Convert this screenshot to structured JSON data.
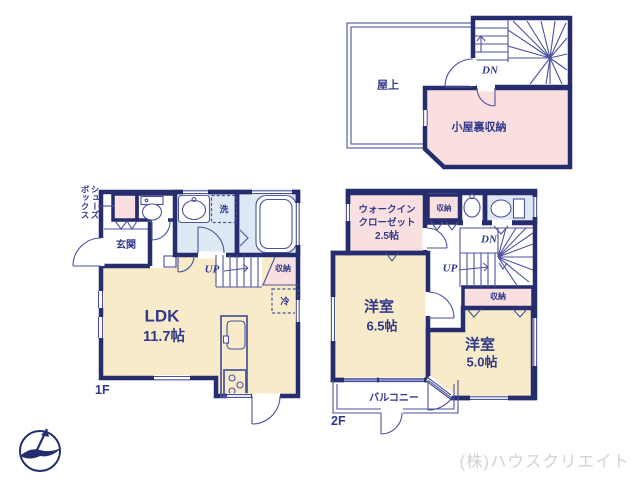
{
  "colors": {
    "wall": "#262d6e",
    "line": "#4b529c",
    "label": "#32398a",
    "cream": "#f7ebc9",
    "pink": "#f9dfdf",
    "blue": "#dfe9f5",
    "watermark": "#d2d2d2"
  },
  "watermark": "(株)ハウスクリエイト",
  "roof_plan": {
    "terrace": "屋上",
    "attic": "小屋裏収納",
    "down": "DN"
  },
  "floor_1": {
    "label": "1F",
    "shoebox_col1": "シューズ",
    "shoebox_col2": "ボックス",
    "entrance": "玄関",
    "laundry": "洗",
    "up": "UP",
    "stair_storage": "収納",
    "fridge": "冷",
    "ldk": "LDK",
    "ldk_size": "11.7帖"
  },
  "floor_2": {
    "label": "2F",
    "wic_line1": "ウォークイン",
    "wic_line2": "クローゼット",
    "wic_size": "2.5帖",
    "closet_top": "収納",
    "down": "DN",
    "up": "UP",
    "closet_stairs": "収納",
    "bedroom1": "洋室",
    "bedroom1_size": "6.5帖",
    "bedroom2": "洋室",
    "bedroom2_size": "5.0帖",
    "balcony": "バルコニー"
  }
}
